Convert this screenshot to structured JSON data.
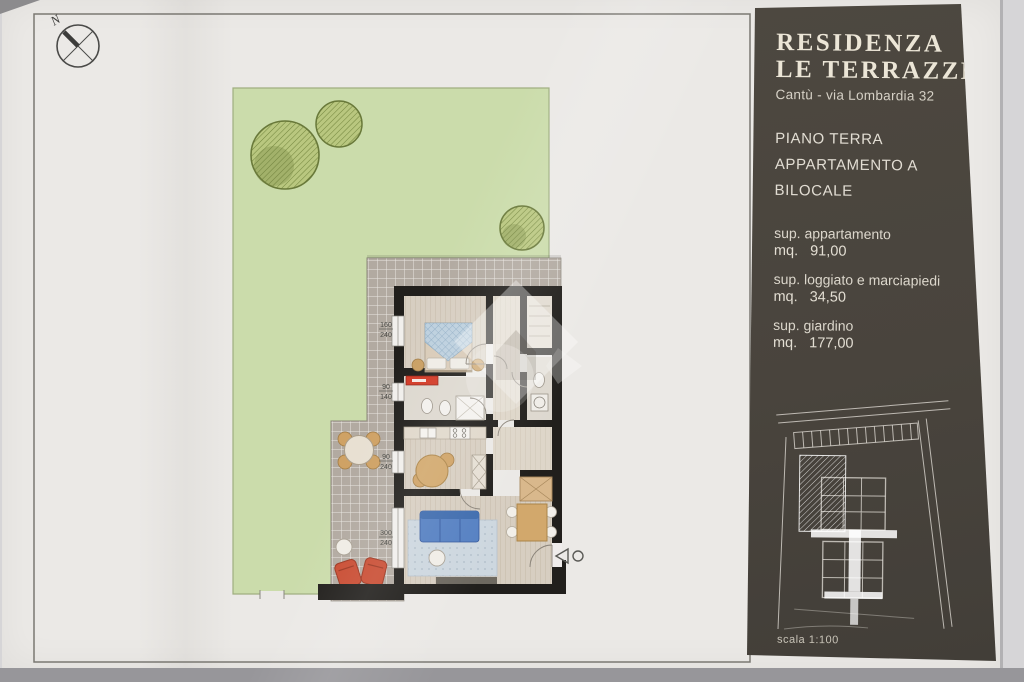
{
  "colors": {
    "panel_brown": "#49443d",
    "garden_green": "#cbdcab",
    "wall_black": "#211f1c",
    "sofa_blue": "#5580c2",
    "terracotta": "#c94c32",
    "paper": "#ebe9e6"
  },
  "plan": {
    "north_label": "N",
    "window_dimensions": [
      {
        "w": "160",
        "h": "240"
      },
      {
        "w": "90",
        "h": "140"
      },
      {
        "w": "90",
        "h": "240"
      },
      {
        "w": "300",
        "h": "240"
      }
    ]
  },
  "panel": {
    "title_line1": "RESIDENZA",
    "title_line2": "LE TERRAZZE",
    "address": "Cantù - via Lombardia 32",
    "floor": "PIANO TERRA",
    "unit": "APPARTAMENTO A",
    "type": "BILOCALE",
    "areas": [
      {
        "label": "sup. appartamento",
        "unit": "mq.",
        "value": "91,00"
      },
      {
        "label": "sup. loggiato e marciapiedi",
        "unit": "mq.",
        "value": "34,50"
      },
      {
        "label": "sup. giardino",
        "unit": "mq.",
        "value": "177,00"
      }
    ],
    "scale": "scala 1:100"
  }
}
